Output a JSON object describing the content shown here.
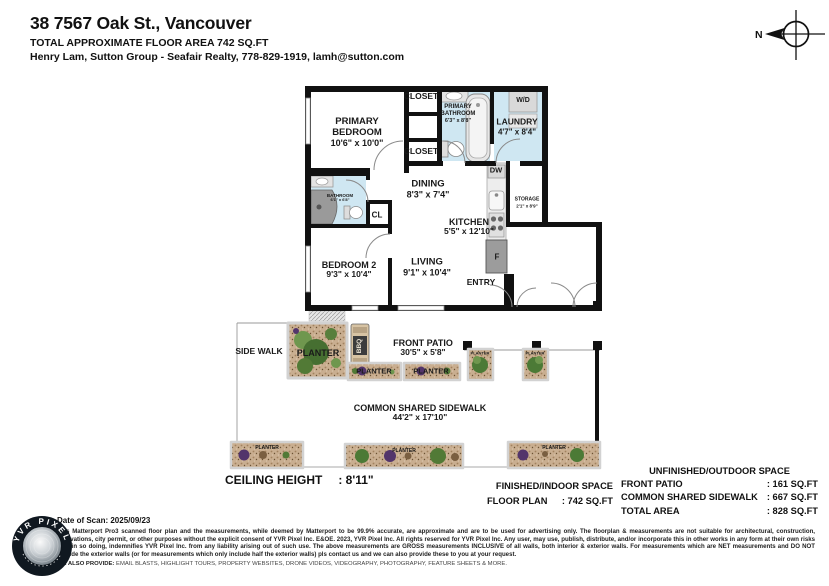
{
  "header": {
    "address": "38 7567 Oak St., Vancouver",
    "area_line": "TOTAL APPROXIMATE FLOOR AREA 742 SQ.FT",
    "agent_line": "Henry Lam, Sutton Group - Seafair Realty, 778-829-1919, lamh@sutton.com"
  },
  "compass": {
    "north_label": "N"
  },
  "rooms": {
    "primary_bedroom": {
      "name": "PRIMARY BEDROOM",
      "dims": "10'6\" x 10'0\""
    },
    "closet": {
      "name": "CLOSET"
    },
    "primary_bathroom": {
      "name": "PRIMARY BATHROOM",
      "dims": "6'3\" x 8'8\""
    },
    "laundry": {
      "name": "LAUNDRY",
      "dims": "4'7\" x 8'4\""
    },
    "washer_dryer": {
      "name": "W/D"
    },
    "dining": {
      "name": "DINING",
      "dims": "8'3\" x 7'4\""
    },
    "dishwasher": {
      "name": "DW"
    },
    "kitchen": {
      "name": "KITCHEN",
      "dims": "5'5\" x 12'10\""
    },
    "storage": {
      "name": "STORAGE",
      "dims": "2'1\" x 8'9\""
    },
    "bathroom": {
      "name": "BATHROOM",
      "dims": "6'1\" x 6'8\""
    },
    "hall_closet": {
      "name": "CL"
    },
    "bedroom2": {
      "name": "BEDROOM 2",
      "dims": "9'3\" x 10'4\""
    },
    "living": {
      "name": "LIVING",
      "dims": "9'1\" x 10'4\""
    },
    "entry": {
      "name": "ENTRY"
    },
    "fridge": {
      "name": "F"
    },
    "bbq": {
      "name": "BBQ"
    },
    "front_patio": {
      "name": "FRONT PATIO",
      "dims": "30'5\" x 5'8\""
    },
    "side_walk": {
      "name": "SIDE WALK"
    },
    "planter": {
      "name": "PLANTER"
    },
    "common_sidewalk": {
      "name": "COMMON SHARED SIDEWALK",
      "dims": "44'2\" x 17'10\""
    }
  },
  "summary": {
    "ceiling_label": "CEILING HEIGHT",
    "ceiling_value": ": 8'11\"",
    "indoor": {
      "title": "FINISHED/INDOOR SPACE",
      "rows": [
        {
          "label": "FLOOR PLAN",
          "value": ": 742 SQ.FT"
        }
      ]
    },
    "outdoor": {
      "title": "UNFINISHED/OUTDOOR SPACE",
      "rows": [
        {
          "label": "FRONT PATIO",
          "value": ": 161 SQ.FT"
        },
        {
          "label": "COMMON SHARED SIDEWALK",
          "value": ": 667 SQ.FT"
        },
        {
          "label": "TOTAL AREA",
          "value": ": 828 SQ.FT"
        }
      ]
    }
  },
  "footer": {
    "scan_date": "Date of Scan: 2025/09/23",
    "disclaimer": "This Matterport Pro3 scanned floor plan and the measurements, while deemed by Matterport to be 99.9% accurate, are approximate and are to be used for advertising only. The floorplan & measurements are not suitable for architectural, construction, renovations, city permit, or other purposes without the explicit consent of YVR Pixel Inc. E&OE. 2023, YVR Pixel Inc. All rights reserved for YVR Pixel Inc. Any user, may use, publish, distribute, and/or incorporate this in other works in any form at their own risks and, in so doing, indemnifies YVR Pixel Inc. from any liability arising out of such use. The above measurements are GROSS measurements INCLUSIVE of all walls, both interior & exterior walls. For measurements which are NET measurements and DO NOT include the exterior walls (or for measurements which only include half the exterior walls) pls contact us and we can also provide these to you at your request.",
    "provide_label": "WE ALSO PROVIDE:",
    "provide_text": " EMAIL BLASTS, HIGHLIGHT TOURS, PROPERTY WEBSITES, DRONE VIDEOS, VIDEOGRAPHY, PHOTOGRAPHY, FEATURE SHEETS & MORE.",
    "stamp_text": "YVR PIXEL"
  },
  "colors": {
    "wet_room_fill": "#cfe7f2",
    "wall": "#111111",
    "soil": "#c9ae90",
    "plant_green": "#4c7a36",
    "plant_purple": "#53356b"
  }
}
